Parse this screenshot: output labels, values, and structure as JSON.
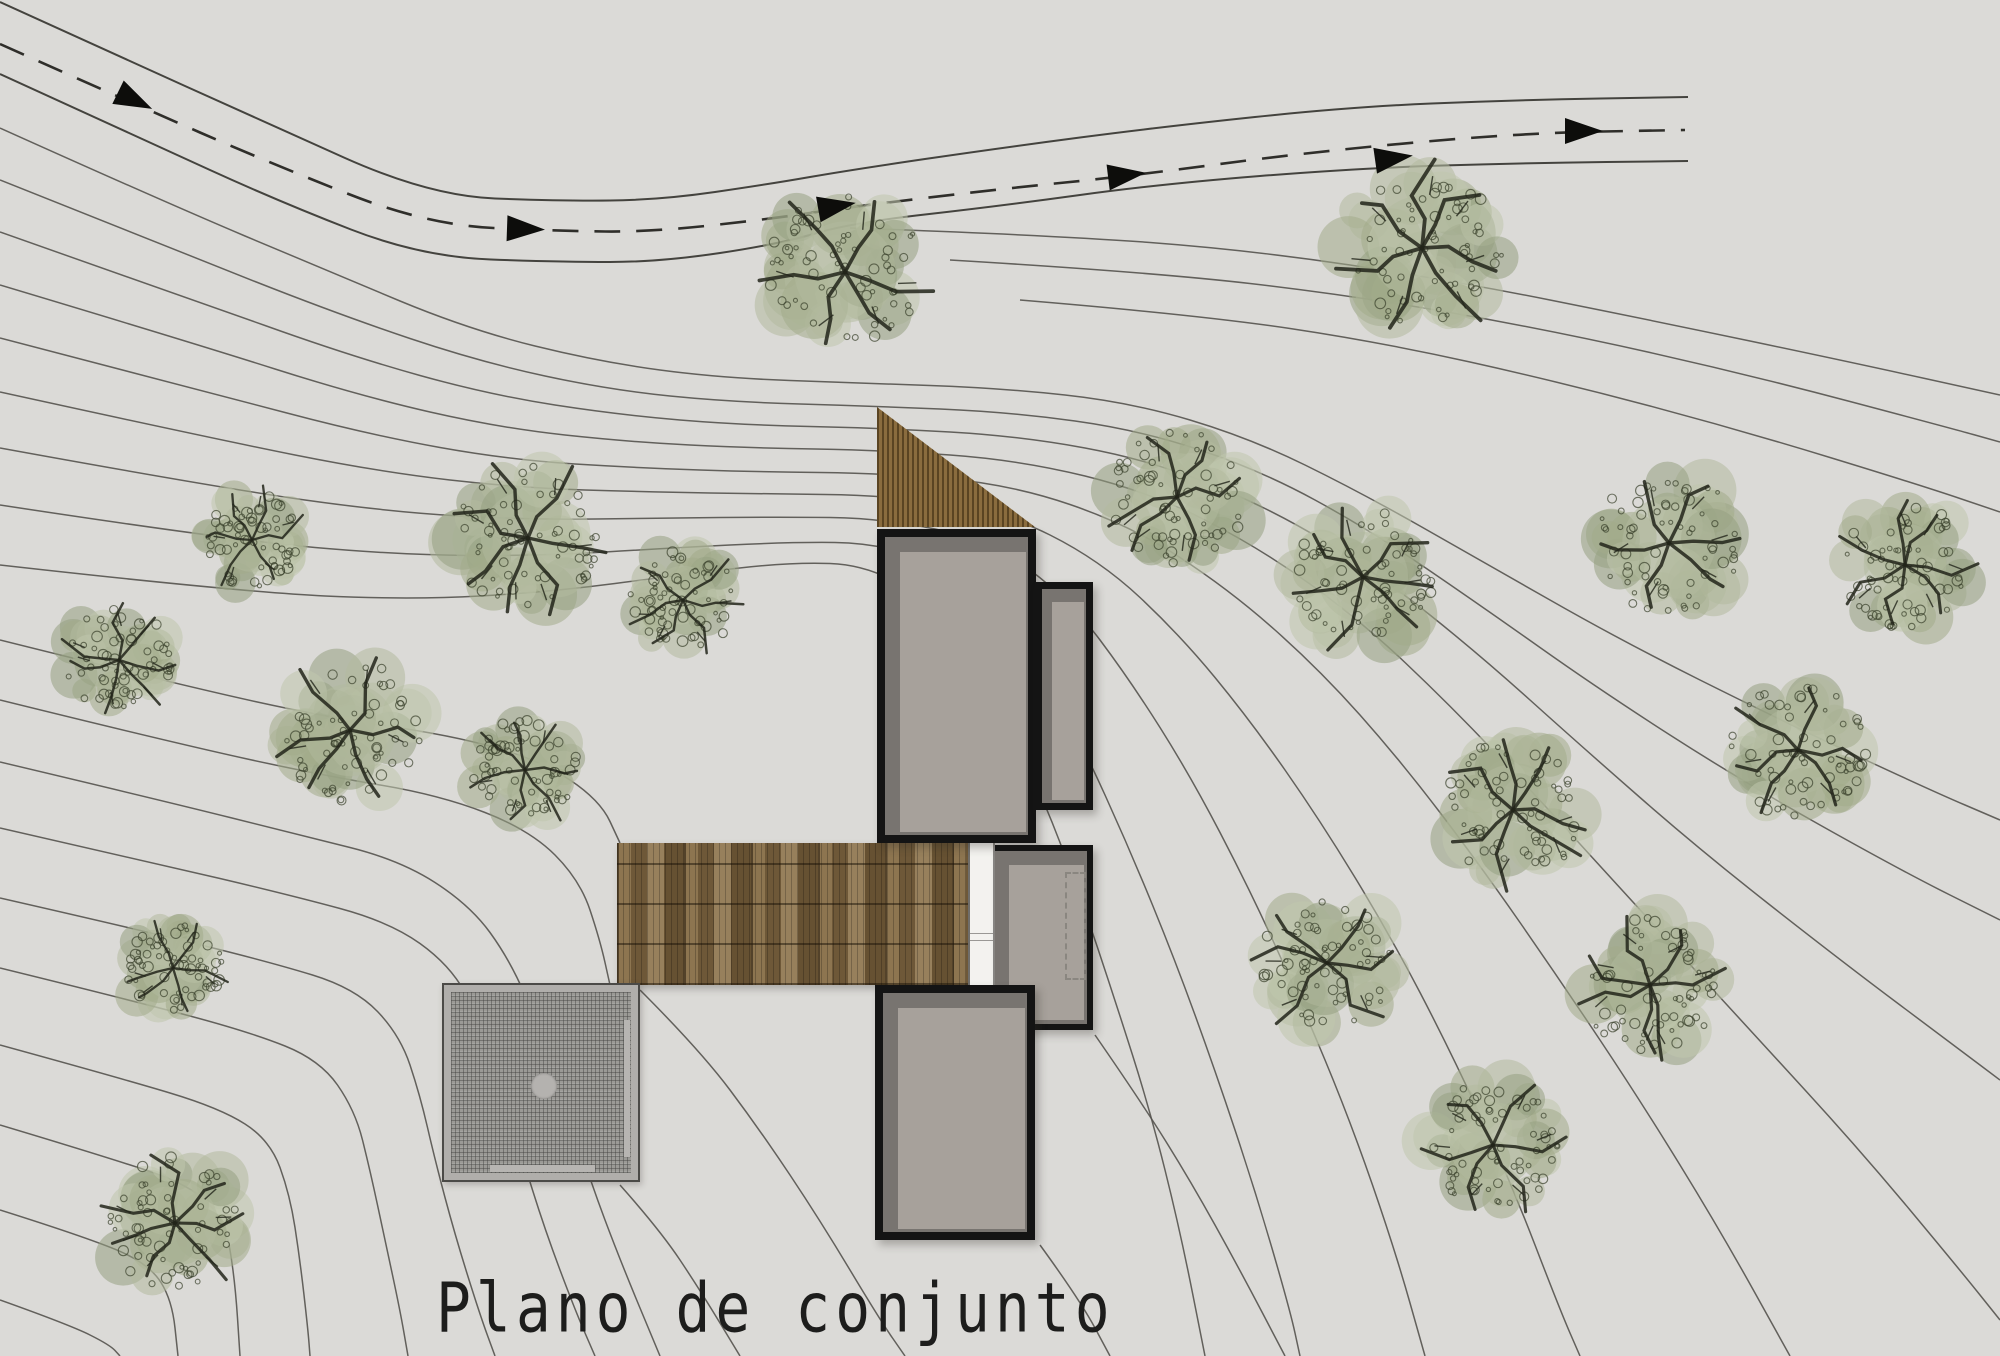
{
  "title": {
    "text": "Plano de conjunto"
  },
  "colors": {
    "background": "#dbdad7",
    "contour_line": "#54524e",
    "road_line": "#44433e",
    "road_dash": "#2f2e2a",
    "building_outline": "#141414",
    "building_dark_fill": "#787470",
    "building_light_fill": "#a7a19b",
    "roof_wood": "#8a6c3e",
    "deck_wood": "#7b6545",
    "patio_fill": "#9b9a96",
    "tree_canopy": [
      "#b2ba9e",
      "#a2ac8b",
      "#c0c6ad",
      "#96a182"
    ],
    "tree_texture": "#3b412c",
    "tree_branch": "#22251a",
    "arrow": "#0d0d0b"
  },
  "site": {
    "trees": [
      [
        845,
        272,
        92
      ],
      [
        1422,
        248,
        95
      ],
      [
        252,
        540,
        58
      ],
      [
        528,
        538,
        86
      ],
      [
        683,
        600,
        62
      ],
      [
        119,
        660,
        63
      ],
      [
        350,
        730,
        84
      ],
      [
        525,
        770,
        63
      ],
      [
        173,
        968,
        58
      ],
      [
        175,
        1223,
        78
      ],
      [
        1177,
        497,
        80
      ],
      [
        1363,
        577,
        82
      ],
      [
        1669,
        543,
        85
      ],
      [
        1905,
        565,
        75
      ],
      [
        1798,
        750,
        80
      ],
      [
        1513,
        810,
        83
      ],
      [
        1327,
        963,
        80
      ],
      [
        1650,
        985,
        80
      ],
      [
        1493,
        1145,
        78
      ]
    ],
    "road": {
      "arrows": [
        {
          "x": 136,
          "y": 101,
          "angle": 26
        },
        {
          "x": 527,
          "y": 229,
          "angle": 2
        },
        {
          "x": 838,
          "y": 206,
          "angle": -10
        },
        {
          "x": 1128,
          "y": 175,
          "angle": -7
        },
        {
          "x": 1395,
          "y": 158,
          "angle": -8
        },
        {
          "x": 1585,
          "y": 131,
          "angle": 0
        }
      ]
    }
  }
}
